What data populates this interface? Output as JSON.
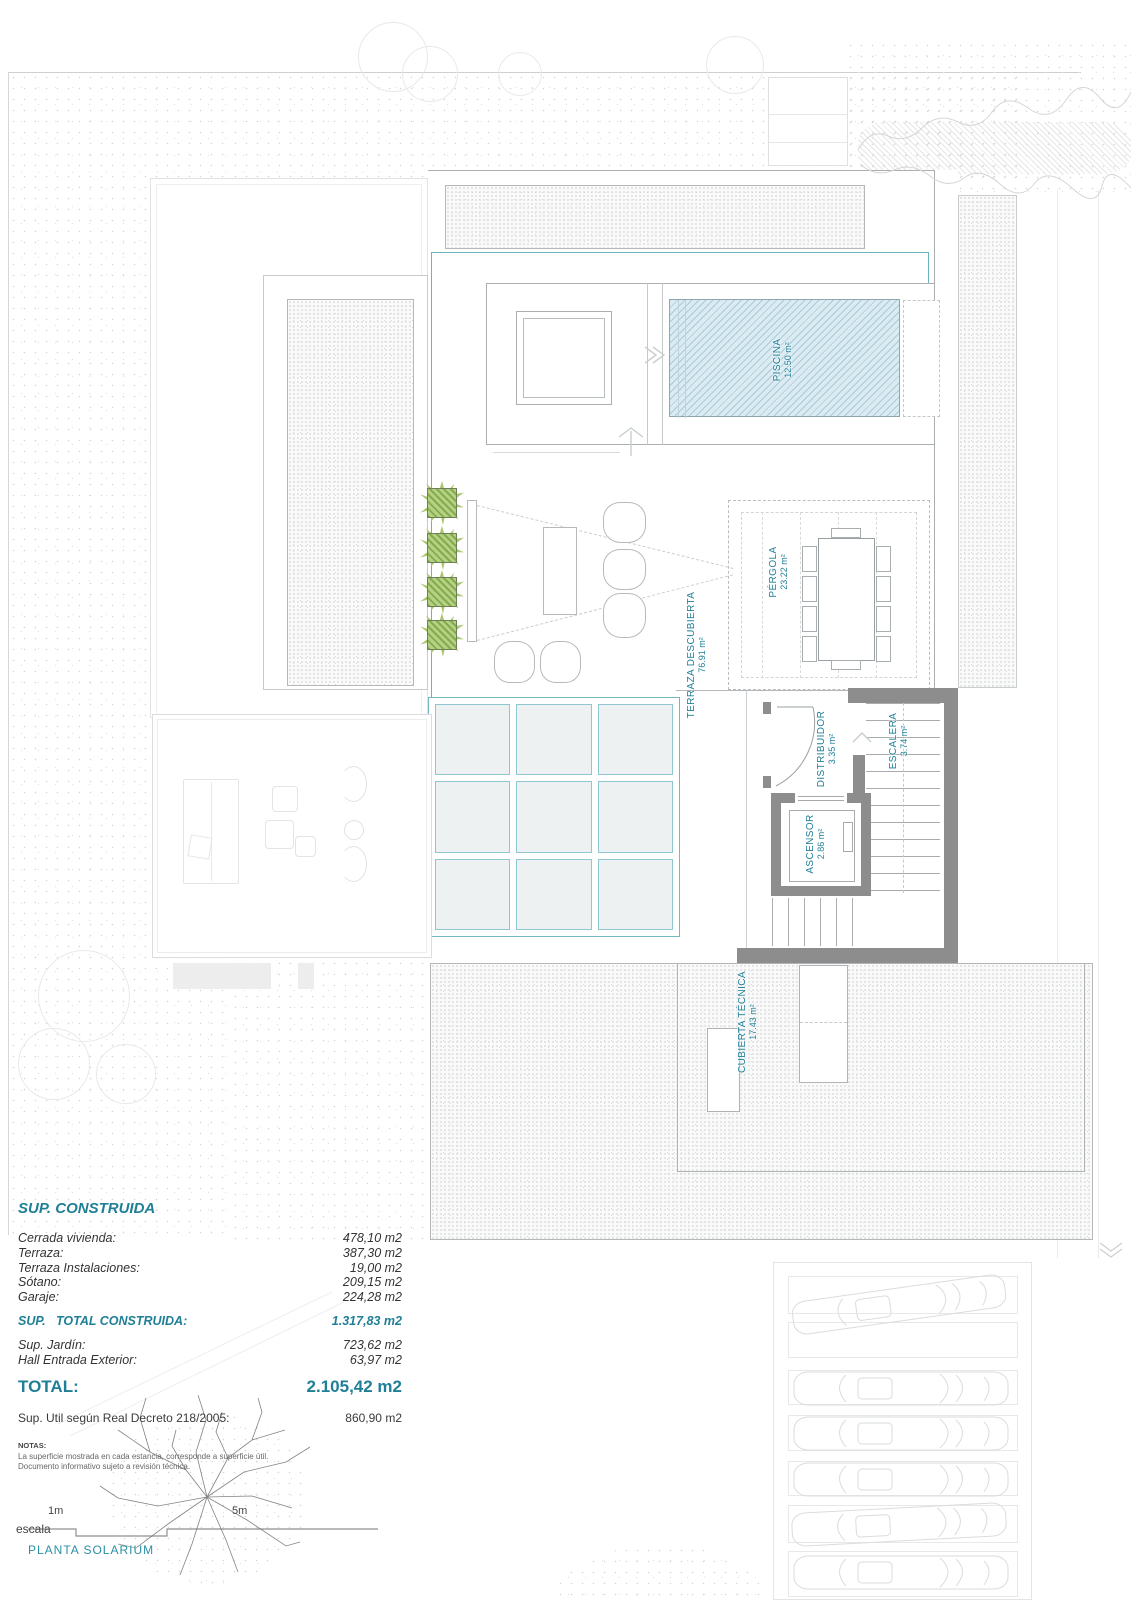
{
  "plan": {
    "rooms": {
      "piscina": {
        "name": "PISCINA",
        "area": "12.50 m²"
      },
      "terraza_descubierta": {
        "name": "TERRAZA DESCUBIERTA",
        "area": "76.91 m²"
      },
      "pergola": {
        "name": "PÉRGOLA",
        "area": "23.22 m²"
      },
      "distribuidor": {
        "name": "DISTRIBUIDOR",
        "area": "3.35 m²"
      },
      "escalera": {
        "name": "ESCALERA",
        "area": "3.74 m²"
      },
      "ascensor": {
        "name": "ASCENSOR",
        "area": "2.86 m²"
      },
      "cubierta_tecnica": {
        "name": "CUBIERTA TÉCNICA",
        "area": "17.43 m²"
      }
    }
  },
  "summary": {
    "title": "SUP. CONSTRUIDA",
    "rows": [
      {
        "label": "Cerrada vivienda:",
        "value": "478,10 m2"
      },
      {
        "label": "Terraza:",
        "value": "387,30 m2"
      },
      {
        "label": "Terraza Instalaciones:",
        "value": "19,00 m2"
      },
      {
        "label": "Sótano:",
        "value": "209,15 m2"
      },
      {
        "label": "Garaje:",
        "value": "224,28 m2"
      }
    ],
    "subtotal": {
      "label": "SUP.   TOTAL CONSTRUIDA:",
      "value": "1.317,83 m2"
    },
    "extra_rows": [
      {
        "label": "Sup. Jardín:",
        "value": "723,62 m2"
      },
      {
        "label": "Hall Entrada Exterior:",
        "value": "63,97 m2"
      }
    ],
    "total": {
      "label": "TOTAL:",
      "value": "2.105,42 m2"
    },
    "util": {
      "label": "Sup. Util según Real Decreto 218/2005:",
      "value": "860,90 m2"
    },
    "notes": {
      "heading": "NOTAS:",
      "lines": [
        "La superficie mostrada en cada estancia, corresponde a superficie útil.",
        "Documento informativo sujeto a revisión técnica."
      ]
    },
    "accent_color": "#1f7f97"
  },
  "footer": {
    "scale_label": "escala",
    "scale_1m": "1m",
    "scale_5m": "5m",
    "plan_title": "PLANTA SOLARIUM"
  }
}
